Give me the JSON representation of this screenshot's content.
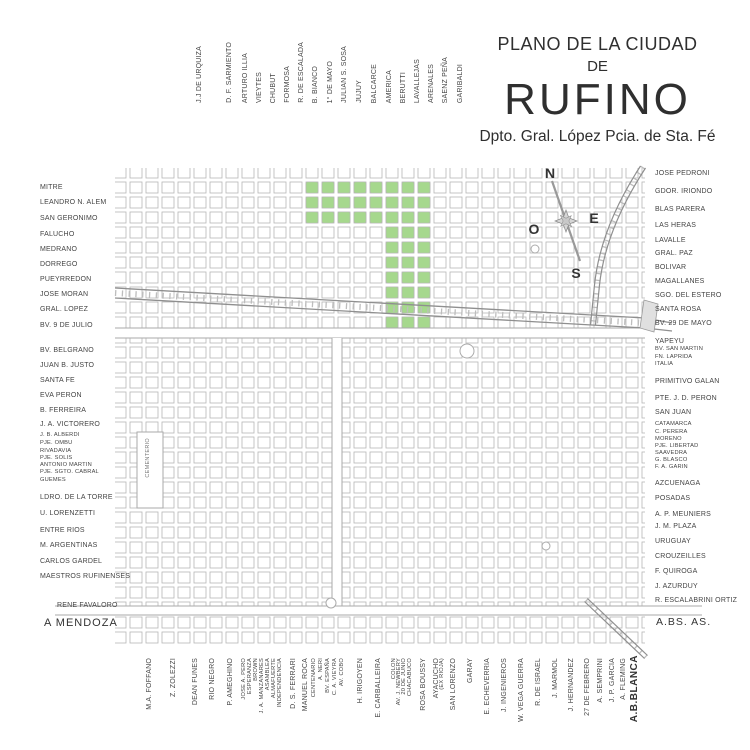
{
  "title": {
    "line1": "PLANO DE LA CIUDAD",
    "line2": "DE",
    "line3": "RUFINO",
    "subtitle": "Dpto. Gral. López Pcia. de Sta. Fé"
  },
  "compass": {
    "n": "N",
    "s": "S",
    "e": "E",
    "o": "O"
  },
  "cemetery_label": "CEMENTERIO",
  "colors": {
    "highlight_green": "#a6d88d",
    "block_outline": "#b5b5b5",
    "railway": "#949494",
    "text": "#3a3a3a"
  },
  "exits": {
    "west": "A MENDOZA",
    "east": "A.BS. AS.",
    "south": "A.B.BLANCA"
  },
  "highlight": {
    "color": "#a6d88d",
    "bands": [
      {
        "xs": [
          304,
          320,
          336,
          352,
          368,
          384,
          400,
          416
        ],
        "ys": [
          180,
          195,
          210
        ]
      },
      {
        "xs": [
          384,
          400,
          416
        ],
        "ys": [
          225,
          240,
          255,
          270,
          285,
          300,
          315
        ]
      }
    ]
  },
  "streets": {
    "top": [
      {
        "name": "J.J DE URQUIZA",
        "x": 196
      },
      {
        "name": "D. F. SARMIENTO",
        "x": 226
      },
      {
        "name": "ARTURO ILLIA",
        "x": 242
      },
      {
        "name": "VIEYTES",
        "x": 256
      },
      {
        "name": "CHUBUT",
        "x": 270
      },
      {
        "name": "FORMOSA",
        "x": 284
      },
      {
        "name": "R. DE ESCALADA",
        "x": 298
      },
      {
        "name": "B. BIANCO",
        "x": 312
      },
      {
        "name": "1° DE MAYO",
        "x": 327
      },
      {
        "name": "JULIAN S. SOSA",
        "x": 341
      },
      {
        "name": "JUJUY",
        "x": 356
      },
      {
        "name": "BALCARCE",
        "x": 371
      },
      {
        "name": "AMERICA",
        "x": 386
      },
      {
        "name": "BERUTTI",
        "x": 400
      },
      {
        "name": "LAVALLEJAS",
        "x": 414
      },
      {
        "name": "ARENALES",
        "x": 428
      },
      {
        "name": "SAENZ PEÑA",
        "x": 442
      },
      {
        "name": "GARIBALDI",
        "x": 457
      }
    ],
    "left": [
      {
        "name": "MITRE",
        "y": 184
      },
      {
        "name": "LEANDRO N. ALEM",
        "y": 199
      },
      {
        "name": "SAN GERONIMO",
        "y": 215
      },
      {
        "name": "FALUCHO",
        "y": 231
      },
      {
        "name": "MEDRANO",
        "y": 246
      },
      {
        "name": "DORREGO",
        "y": 261
      },
      {
        "name": "PUEYRREDON",
        "y": 276
      },
      {
        "name": "JOSE MORAN",
        "y": 291
      },
      {
        "name": "GRAL. LOPEZ",
        "y": 306
      },
      {
        "name": "BV. 9 DE JULIO",
        "y": 322
      },
      {
        "name": "BV. BELGRANO",
        "y": 347
      },
      {
        "name": "JUAN B. JUSTO",
        "y": 362
      },
      {
        "name": "SANTA FE",
        "y": 377
      },
      {
        "name": "EVA PERON",
        "y": 392
      },
      {
        "name": "B. FERREIRA",
        "y": 407
      },
      {
        "name": "J. A. VICTORERO",
        "y": 421
      },
      {
        "name": "J. B. ALBERDI",
        "y": 433,
        "small": true
      },
      {
        "name": "PJE. OMBU",
        "y": 441,
        "small": true
      },
      {
        "name": "RIVADAVIA",
        "y": 449,
        "small": true
      },
      {
        "name": "PJE. SOLIS",
        "y": 456,
        "small": true
      },
      {
        "name": "ANTONIO MARTIN",
        "y": 463,
        "small": true
      },
      {
        "name": "PJE. SGTO. CABRAL",
        "y": 470,
        "small": true
      },
      {
        "name": "GUEMES",
        "y": 478,
        "small": true
      },
      {
        "name": "LDRO. DE LA TORRE",
        "y": 494
      },
      {
        "name": "U. LORENZETTI",
        "y": 510
      },
      {
        "name": "ENTRE RIOS",
        "y": 527
      },
      {
        "name": "M. ARGENTINAS",
        "y": 542
      },
      {
        "name": "CARLOS GARDEL",
        "y": 558
      },
      {
        "name": "MAESTROS RUFINENSES",
        "y": 573
      },
      {
        "name": "RENE FAVALORO",
        "y": 602,
        "x": 57
      }
    ],
    "right": [
      {
        "name": "JOSE PEDRONI",
        "y": 170
      },
      {
        "name": "GDOR. IRIONDO",
        "y": 188
      },
      {
        "name": "BLAS PARERA",
        "y": 206
      },
      {
        "name": "LAS HERAS",
        "y": 222
      },
      {
        "name": "LAVALLE",
        "y": 237
      },
      {
        "name": "GRAL. PAZ",
        "y": 250
      },
      {
        "name": "BOLIVAR",
        "y": 264
      },
      {
        "name": "MAGALLANES",
        "y": 278
      },
      {
        "name": "SGO. DEL ESTERO",
        "y": 292
      },
      {
        "name": "SANTA ROSA",
        "y": 306
      },
      {
        "name": "BV. 29 DE MAYO",
        "y": 320
      },
      {
        "name": "YAPEYU",
        "y": 338
      },
      {
        "name": "BV. SAN MARTIN",
        "y": 347,
        "small": true
      },
      {
        "name": "FN. LAPRIDA",
        "y": 355,
        "small": true
      },
      {
        "name": "ITALIA",
        "y": 362,
        "small": true
      },
      {
        "name": "PRIMITIVO GALAN",
        "y": 378
      },
      {
        "name": "PTE. J. D. PERON",
        "y": 395
      },
      {
        "name": "SAN JUAN",
        "y": 409
      },
      {
        "name": "CATAMARCA",
        "y": 422,
        "small": true
      },
      {
        "name": "C. PERERA",
        "y": 430,
        "small": true
      },
      {
        "name": "MORENO",
        "y": 437,
        "small": true
      },
      {
        "name": "PJE. LIBERTAD",
        "y": 444,
        "small": true
      },
      {
        "name": "SAAVEDRA",
        "y": 451,
        "small": true
      },
      {
        "name": "G. BLASCO",
        "y": 458,
        "small": true
      },
      {
        "name": "F. A. GARIN",
        "y": 465,
        "small": true
      },
      {
        "name": "AZCUENAGA",
        "y": 480
      },
      {
        "name": "POSADAS",
        "y": 495
      },
      {
        "name": "A. P. MEUNIERS",
        "y": 511
      },
      {
        "name": "J. M. PLAZA",
        "y": 523
      },
      {
        "name": "URUGUAY",
        "y": 538
      },
      {
        "name": "CROUZEILLES",
        "y": 553
      },
      {
        "name": "F. QUIROGA",
        "y": 568
      },
      {
        "name": "J. AZURDUY",
        "y": 583
      },
      {
        "name": "R. ESCALABRINI ORTIZ",
        "y": 597
      }
    ],
    "bottom": [
      {
        "name": "M.A. FOFFANO",
        "x": 146
      },
      {
        "name": "Z. ZOLEZZI",
        "x": 170
      },
      {
        "name": "DEAN FUNES",
        "x": 192
      },
      {
        "name": "RIO NEGRO",
        "x": 209
      },
      {
        "name": "P. AMEGHINO",
        "x": 227
      },
      {
        "name": "JOSE A. PERO",
        "x": 242,
        "small": true
      },
      {
        "name": "ESPERANZA",
        "x": 248,
        "small": true
      },
      {
        "name": "BROWN",
        "x": 254,
        "small": true
      },
      {
        "name": "J. A. MANZANARES",
        "x": 260,
        "small": true
      },
      {
        "name": "ASAMBLEA",
        "x": 266,
        "small": true
      },
      {
        "name": "ALMAFUERTE",
        "x": 272,
        "small": true
      },
      {
        "name": "INDEPENDENCIA",
        "x": 278,
        "small": true
      },
      {
        "name": "D. S. FERRARI",
        "x": 290
      },
      {
        "name": "MANUEL ROCA",
        "x": 302
      },
      {
        "name": "CENTENARIO",
        "x": 312,
        "small": true
      },
      {
        "name": "A. NERI",
        "x": 319,
        "small": true
      },
      {
        "name": "BV. ESPAÑA",
        "x": 326,
        "small": true
      },
      {
        "name": "C. A. VIEYRA",
        "x": 333,
        "small": true
      },
      {
        "name": "AV. COBO",
        "x": 340,
        "small": true
      },
      {
        "name": "H. IRIGOYEN",
        "x": 357
      },
      {
        "name": "E. CARBALLEIRA",
        "x": 375
      },
      {
        "name": "COLON",
        "x": 392,
        "small": true
      },
      {
        "name": "AV. J. NEWBERY",
        "x": 397,
        "small": true
      },
      {
        "name": "20 DE JUNIO",
        "x": 402,
        "small": true
      },
      {
        "name": "CHACABUCO",
        "x": 408,
        "small": true
      },
      {
        "name": "ROSA BOUSSY",
        "x": 420
      },
      {
        "name": "AYACUCHO",
        "x": 433
      },
      {
        "name": "(EX RIOJA)",
        "x": 440,
        "small": true
      },
      {
        "name": "SAN LORENZO",
        "x": 450
      },
      {
        "name": "GARAY",
        "x": 467
      },
      {
        "name": "E. ECHEVERRIA",
        "x": 484
      },
      {
        "name": "J. INGENIEROS",
        "x": 501
      },
      {
        "name": "W. VEGA GUERRA",
        "x": 518
      },
      {
        "name": "R. DE ISRAEL",
        "x": 535
      },
      {
        "name": "J. MARMOL",
        "x": 552
      },
      {
        "name": "J. HERNANDEZ",
        "x": 568
      },
      {
        "name": "27 DE FEBRERO",
        "x": 584
      },
      {
        "name": "A. SEMPRINI",
        "x": 597
      },
      {
        "name": "J. P. GARCIA",
        "x": 609
      },
      {
        "name": "A. FLEMING",
        "x": 620
      }
    ]
  }
}
